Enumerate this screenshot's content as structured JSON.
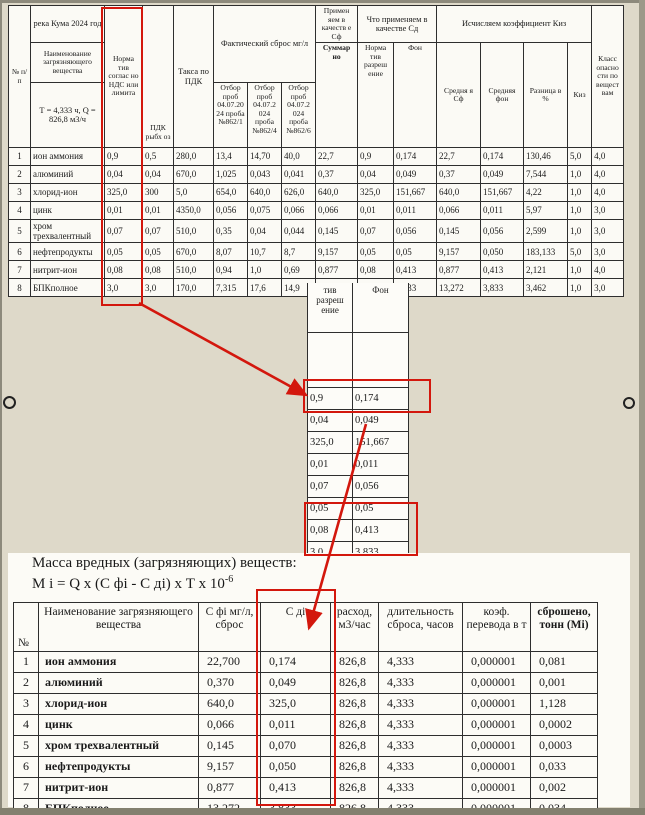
{
  "accent_red": "#d3170d",
  "upper_table": {
    "headers": {
      "num": "№ п/п",
      "river": "река Кума 2024 год",
      "name": "Наименование загрязняющего вещества",
      "tq": "Т = 4,333 ч, Q = 826,8 м3/ч",
      "nds": "Норма тив соглас но НДС или лимита",
      "pdk": "ПДК рыбх оз",
      "taksa": "Такса по ПДК",
      "fact": "Фактический сброс мг/л",
      "otbor1": "Отбор проб 04.07.20 24 проба №862/1",
      "otbor2": "Отбор проб 04.07.2 024 проба №862/4",
      "otbor3": "Отбор проб 04.07.2 024 проба №862/6",
      "primen": "Примен яем в качеств е Сф",
      "summarno": "Суммар но",
      "chto": "Что применяем в качестве Сд",
      "norm": "Норма тив разреш ение",
      "fon": "Фон",
      "kiz_group": "Исчисляем коэффициент Киз",
      "sred_sf": "Средня я Сф",
      "sred_fon": "Средняя фон",
      "raznica": "Разница в %",
      "kiz": "Киз",
      "klass": "Класс опасно сти по вещест вам"
    },
    "rows": [
      [
        "1",
        "ион аммония",
        "0,9",
        "0,5",
        "280,0",
        "13,4",
        "14,70",
        "40,0",
        "22,7",
        "0,9",
        "0,174",
        "22,7",
        "0,174",
        "130,46",
        "5,0",
        "4,0"
      ],
      [
        "2",
        "алюминий",
        "0,04",
        "0,04",
        "670,0",
        "1,025",
        "0,043",
        "0,041",
        "0,37",
        "0,04",
        "0,049",
        "0,37",
        "0,049",
        "7,544",
        "1,0",
        "4,0"
      ],
      [
        "3",
        "хлорид-ион",
        "325,0",
        "300",
        "5,0",
        "654,0",
        "640,0",
        "626,0",
        "640,0",
        "325,0",
        "151,667",
        "640,0",
        "151,667",
        "4,22",
        "1,0",
        "4,0"
      ],
      [
        "4",
        "цинк",
        "0,01",
        "0,01",
        "4350,0",
        "0,056",
        "0,075",
        "0,066",
        "0,066",
        "0,01",
        "0,011",
        "0,066",
        "0,011",
        "5,97",
        "1,0",
        "3,0"
      ],
      [
        "5",
        "хром трехвалентный",
        "0,07",
        "0,07",
        "510,0",
        "0,35",
        "0,04",
        "0,044",
        "0,145",
        "0,07",
        "0,056",
        "0,145",
        "0,056",
        "2,599",
        "1,0",
        "3,0"
      ],
      [
        "6",
        "нефтепродукты",
        "0,05",
        "0,05",
        "670,0",
        "8,07",
        "10,7",
        "8,7",
        "9,157",
        "0,05",
        "0,05",
        "9,157",
        "0,050",
        "183,133",
        "5,0",
        "3,0"
      ],
      [
        "7",
        "нитрит-ион",
        "0,08",
        "0,08",
        "510,0",
        "0,94",
        "1,0",
        "0,69",
        "0,877",
        "0,08",
        "0,413",
        "0,877",
        "0,413",
        "2,121",
        "1,0",
        "4,0"
      ],
      [
        "8",
        "БПКполное",
        "3,0",
        "3,0",
        "170,0",
        "7,315",
        "17,6",
        "14,9",
        "13,272",
        "3,0",
        "3,833",
        "13,272",
        "3,833",
        "3,462",
        "1,0",
        "3,0"
      ]
    ]
  },
  "fragment_table": {
    "headers": [
      "тив разреш ение",
      "Фон"
    ],
    "rows": [
      [
        "0,9",
        "0,174"
      ],
      [
        "0,04",
        "0,049"
      ],
      [
        "325,0",
        "151,667"
      ],
      [
        "0,01",
        "0,011"
      ],
      [
        "0,07",
        "0,056"
      ],
      [
        "0,05",
        "0,05"
      ],
      [
        "0,08",
        "0,413"
      ],
      [
        "3,0",
        "3,833"
      ]
    ]
  },
  "bottom_section": {
    "title": "Масса вредных (загрязняющих) веществ:",
    "formula": "М i = Q х (С фі - С ді) х Т х 10",
    "formula_exp": "-6",
    "table": {
      "headers": {
        "num": "№",
        "name": "Наименование загрязняющего вещества",
        "cfi": "С фі мг/л, сброс",
        "cdi": "С ді",
        "rashod": "расход, м3/час",
        "dlit": "длительность сброса, часов",
        "koef": "коэф. перевода в т",
        "sbrosheno": "сброшено, тонн (Mi)"
      },
      "rows": [
        [
          "1",
          "ион аммония",
          "22,700",
          "0,174",
          "826,8",
          "4,333",
          "0,000001",
          "0,081"
        ],
        [
          "2",
          "алюминий",
          "0,370",
          "0,049",
          "826,8",
          "4,333",
          "0,000001",
          "0,001"
        ],
        [
          "3",
          "хлорид-ион",
          "640,0",
          "325,0",
          "826,8",
          "4,333",
          "0,000001",
          "1,128"
        ],
        [
          "4",
          "цинк",
          "0,066",
          "0,011",
          "826,8",
          "4,333",
          "0,000001",
          "0,0002"
        ],
        [
          "5",
          "хром трехвалентный",
          "0,145",
          "0,070",
          "826,8",
          "4,333",
          "0,000001",
          "0,0003"
        ],
        [
          "6",
          "нефтепродукты",
          "9,157",
          "0,050",
          "826,8",
          "4,333",
          "0,000001",
          "0,033"
        ],
        [
          "7",
          "нитрит-ион",
          "0,877",
          "0,413",
          "826,8",
          "4,333",
          "0,000001",
          "0,002"
        ],
        [
          "8",
          "БПКполное",
          "13,272",
          "3,833",
          "826,8",
          "4,333",
          "0,000001",
          "0,034"
        ]
      ]
    }
  }
}
